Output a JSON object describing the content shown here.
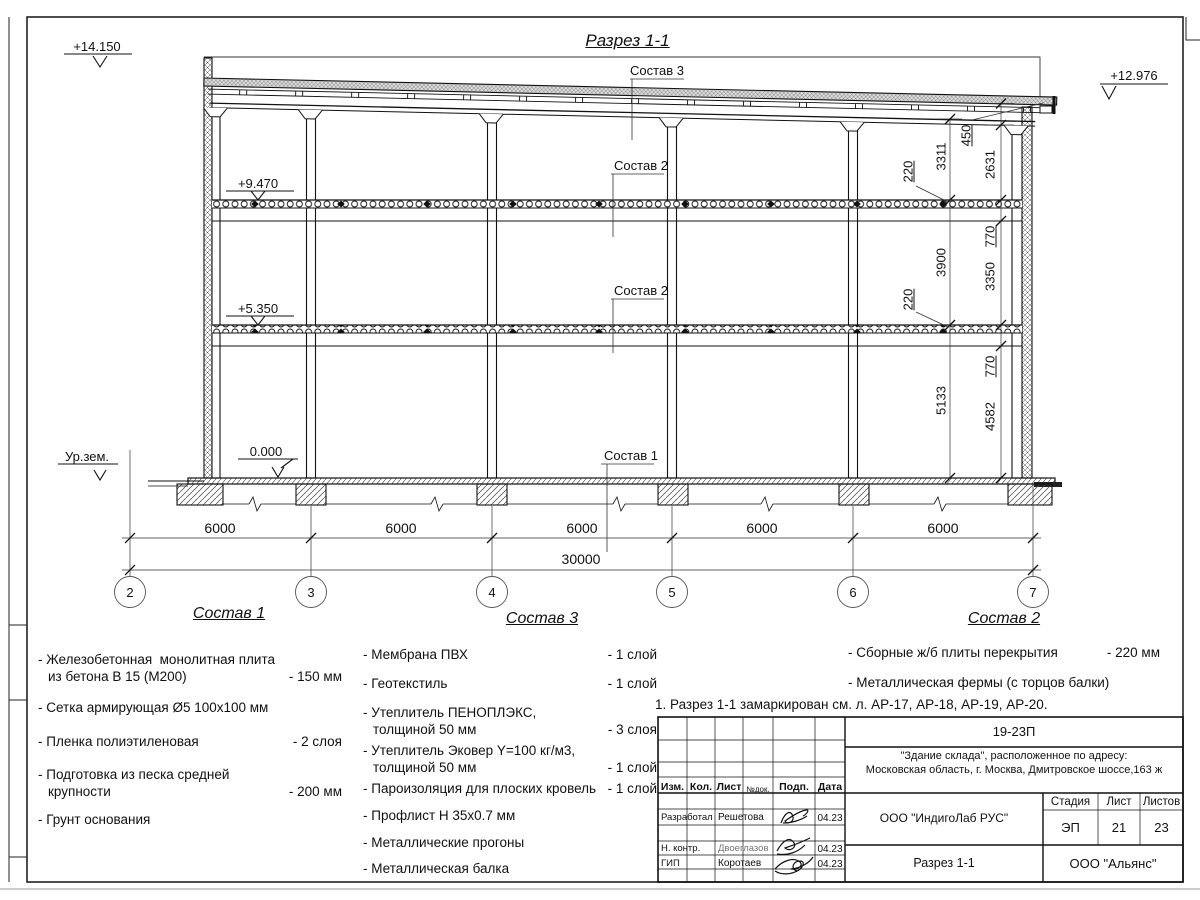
{
  "title": "Разрез 1-1",
  "elevations": {
    "parapet_left": "+14.150",
    "roof_right": "+12.976",
    "floor_upper": "+9.470",
    "floor_lower": "+5.350",
    "ground_floor": "0.000",
    "ground_level": "Ур.зем."
  },
  "drawing_callouts": {
    "roof": "Состав 3",
    "floor_upper": "Состав 2",
    "floor_lower": "Состав 2",
    "slab": "Состав 1"
  },
  "dims": {
    "v_outer": [
      "3311",
      "3900",
      "5133"
    ],
    "v_inner": [
      "450",
      "2631",
      "770",
      "3350",
      "770",
      "4582"
    ],
    "slab_thickness": [
      "220",
      "220"
    ],
    "bays": [
      "6000",
      "6000",
      "6000",
      "6000",
      "6000"
    ],
    "total": "30000"
  },
  "grid": [
    "2",
    "3",
    "4",
    "5",
    "6",
    "7"
  ],
  "legends": {
    "sostav1": {
      "heading": "Состав 1",
      "items": [
        {
          "name": "- Железобетонная  монолитная плита",
          "name2": "из бетона В 15 (М200)",
          "value": "- 150 мм"
        },
        {
          "name": "- Сетка армирующая Ø5 100х100 мм"
        },
        {
          "name": "- Пленка полиэтиленовая",
          "value": "- 2 слоя"
        },
        {
          "name": "- Подготовка из песка средней",
          "name2": "крупности",
          "value": "- 200 мм"
        },
        {
          "name": "- Грунт основания"
        }
      ]
    },
    "sostav3": {
      "heading": "Состав 3",
      "items": [
        {
          "name": "- Мембрана ПВХ",
          "value": "- 1 слой"
        },
        {
          "name": "- Геотекстиль",
          "value": "- 1 слой"
        },
        {
          "name": "- Утеплитель ПЕНОПЛЭКС,",
          "name2": "толщиной 50 мм",
          "value": "- 3 слоя"
        },
        {
          "name": "- Утеплитель Эковер Y=100 кг/м3,",
          "name2": "толщиной 50 мм",
          "value": "- 1 слой"
        },
        {
          "name": "- Пароизоляция для плоских кровель",
          "value": "- 1 слой"
        },
        {
          "name": "- Профлист Н 35х0.7 мм"
        },
        {
          "name": "- Металлические прогоны"
        },
        {
          "name": "- Металлическая балка"
        }
      ]
    },
    "sostav2": {
      "heading": "Состав 2",
      "items": [
        {
          "name": "- Сборные ж/б плиты перекрытия",
          "value": "- 220 мм"
        },
        {
          "name": "- Металлическая фермы (с торцов балки)"
        }
      ]
    }
  },
  "note": "1. Разрез 1-1 замаркирован см. л. АР-17, АР-18, АР-19, АР-20.",
  "titleblock": {
    "code": "19-23П",
    "object_line1": "\"Здание склада\", расположенное по адресу:",
    "object_line2": "Московская область, г. Москва, Дмитровское шоссе,163 ж",
    "designer_company": "ООО \"ИндигоЛаб РУС\"",
    "client_company": "ООО \"Альянс\"",
    "drawing_name": "Разрез 1-1",
    "header": {
      "izm": "Изм.",
      "kol": "Кол.",
      "list": "Лист",
      "ndoc": "№док.",
      "podp": "Подп.",
      "data": "Дата"
    },
    "rows": [
      {
        "role": "Разработал",
        "name": "Решетова",
        "date": "04.23"
      },
      {
        "role": "Н. контр.",
        "name": "Двоеглазов",
        "date": "04.23"
      },
      {
        "role": "ГИП",
        "name": "Коротаев",
        "date": "04.23"
      }
    ],
    "stage_header": {
      "stage": "Стадия",
      "sheet": "Лист",
      "sheets": "Листов"
    },
    "stage_values": {
      "stage": "ЭП",
      "sheet": "21",
      "sheets": "23"
    }
  }
}
